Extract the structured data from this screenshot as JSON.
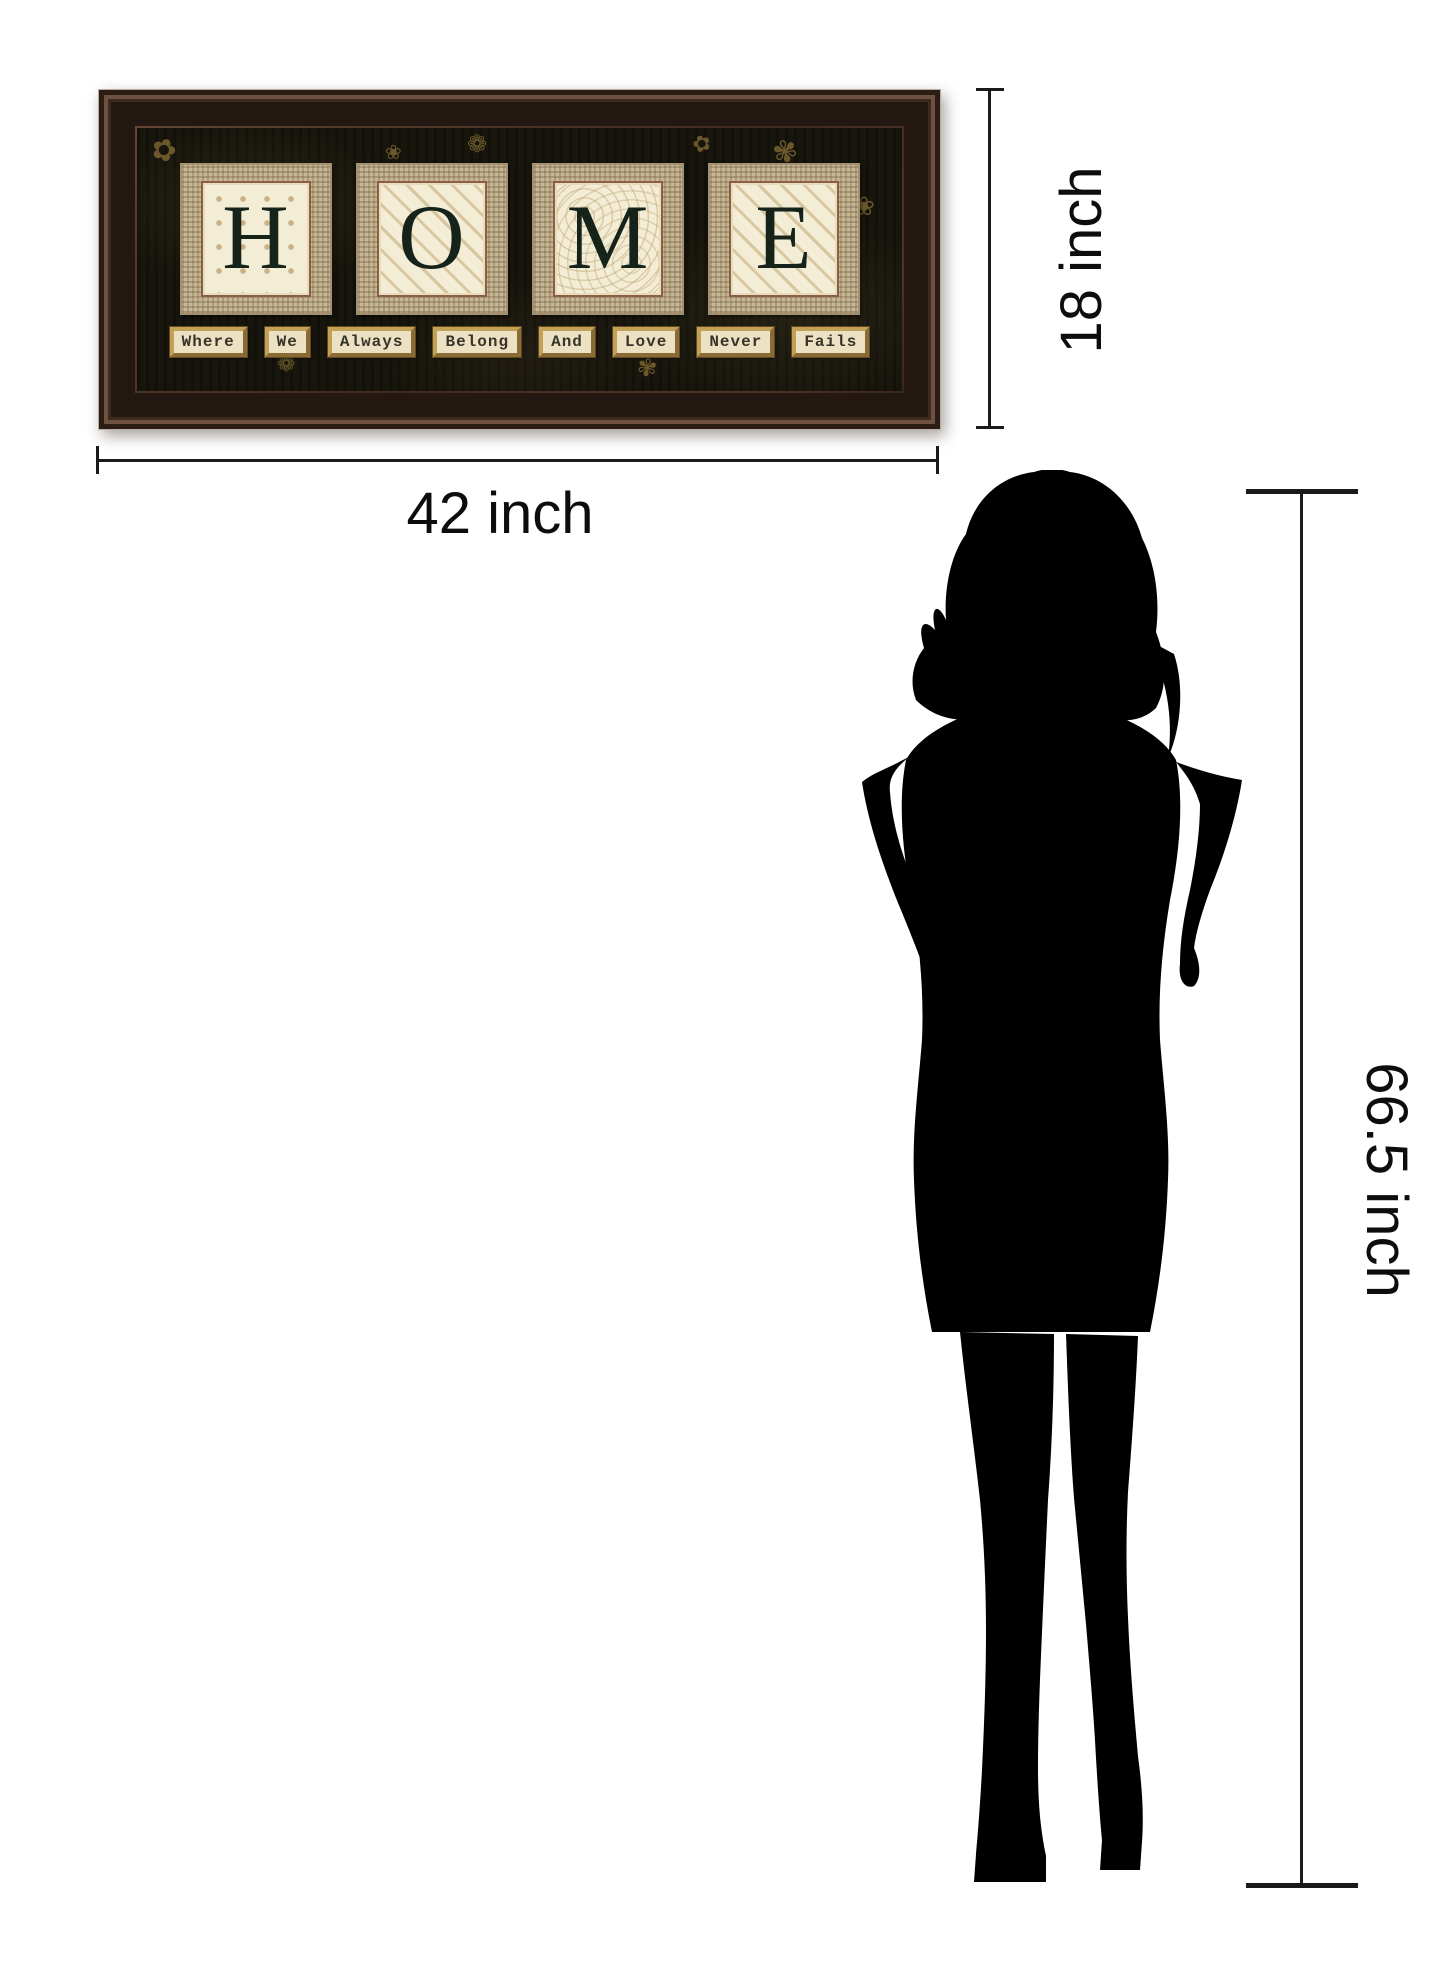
{
  "artwork": {
    "title_word": "HOME",
    "letters": [
      {
        "char": "H",
        "pattern": "dots"
      },
      {
        "char": "O",
        "pattern": "stripes"
      },
      {
        "char": "M",
        "pattern": "swirls"
      },
      {
        "char": "E",
        "pattern": "stripes"
      }
    ],
    "caption_words": [
      "Where",
      "We",
      "Always",
      "Belong",
      "And",
      "Love",
      "Never",
      "Fails"
    ],
    "doodles": [
      {
        "glyph": "✿",
        "x": 14,
        "y": 8,
        "size": 30,
        "rot": 20
      },
      {
        "glyph": "❀",
        "x": 52,
        "y": 140,
        "size": 26,
        "rot": 0
      },
      {
        "glyph": "❁",
        "x": 330,
        "y": 4,
        "size": 24,
        "rot": 0
      },
      {
        "glyph": "✾",
        "x": 636,
        "y": 10,
        "size": 30,
        "rot": -15
      },
      {
        "glyph": "❀",
        "x": 716,
        "y": 66,
        "size": 26,
        "rot": 0
      },
      {
        "glyph": "✿",
        "x": 700,
        "y": 196,
        "size": 30,
        "rot": 25
      },
      {
        "glyph": "❁",
        "x": 140,
        "y": 226,
        "size": 22,
        "rot": 0
      },
      {
        "glyph": "✾",
        "x": 500,
        "y": 228,
        "size": 24,
        "rot": 10
      },
      {
        "glyph": "❀",
        "x": 248,
        "y": 14,
        "size": 20,
        "rot": 0
      },
      {
        "glyph": "✿",
        "x": 556,
        "y": 6,
        "size": 22,
        "rot": -20
      }
    ]
  },
  "measurements": {
    "width": {
      "label": "42 inch"
    },
    "height": {
      "label": "18 inch"
    },
    "person_height": {
      "label": "66.5 inch"
    }
  },
  "colors": {
    "frame_wood": "#4a3527",
    "art_background": "#18150d",
    "burlap": "#c8b795",
    "letter_card": "#f4edd6",
    "letter_ink": "#16231b",
    "gold_doodle": "#9e833f",
    "dimension_line": "#1a1a1a",
    "silhouette": "#000000"
  }
}
